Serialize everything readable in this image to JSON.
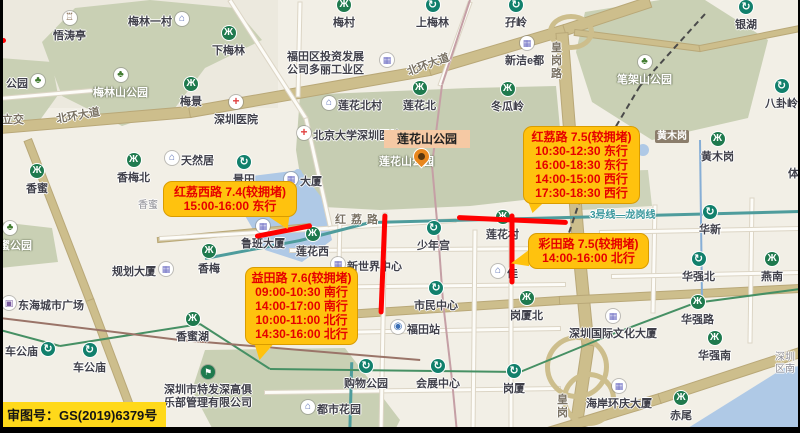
{
  "map": {
    "attribution": "审图号：GS(2019)6379号",
    "park_overlay_label": "莲花山公园",
    "labels": [
      {
        "t": "悟涛亭",
        "x": 53,
        "y": 27,
        "ic": "pavilion",
        "ip": "a"
      },
      {
        "t": "梅林一村",
        "x": 128,
        "y": 13,
        "ic": "house",
        "ip": "r"
      },
      {
        "t": "下梅林",
        "x": 212,
        "y": 42,
        "ic": "szmt",
        "ip": "a"
      },
      {
        "t": "梅村",
        "x": 333,
        "y": 14,
        "ic": "szmt",
        "ip": "a"
      },
      {
        "t": "上梅林",
        "x": 416,
        "y": 14,
        "ic": "mtr",
        "ip": "a"
      },
      {
        "t": "孖岭",
        "x": 505,
        "y": 14,
        "ic": "mtr",
        "ip": "a"
      },
      {
        "t": "银湖",
        "x": 735,
        "y": 16,
        "ic": "mtr",
        "ip": "a"
      },
      {
        "t": "福田区投资发展",
        "x": 287,
        "y": 48
      },
      {
        "t": "公司多丽工业区",
        "x": 287,
        "y": 61
      },
      {
        "t": "",
        "x": 380,
        "y": 53,
        "ic": "building"
      },
      {
        "t": "新洁e都",
        "x": 505,
        "y": 52,
        "ic": "building",
        "ip": "a"
      },
      {
        "t": "公园",
        "x": 6,
        "y": 75,
        "ic": "tree",
        "ip": "r"
      },
      {
        "t": "梅林山公园",
        "x": 93,
        "y": 84,
        "cls": "park",
        "ic": "tree",
        "ip": "a"
      },
      {
        "t": "梅景",
        "x": 180,
        "y": 93,
        "ic": "szmt",
        "ip": "a"
      },
      {
        "t": "深圳医院",
        "x": 214,
        "y": 111,
        "ic": "hosp",
        "ip": "a"
      },
      {
        "t": "北环大道",
        "x": 56,
        "y": 107,
        "cls": "road",
        "r": -10
      },
      {
        "t": "北环大道",
        "x": 406,
        "y": 56,
        "cls": "road",
        "r": -20
      },
      {
        "t": "立交",
        "x": 2,
        "y": 111,
        "cls": "road"
      },
      {
        "t": "莲花北村",
        "x": 338,
        "y": 97,
        "ic": "house",
        "ip": "l"
      },
      {
        "t": "莲花北",
        "x": 403,
        "y": 97,
        "ic": "szmt",
        "ip": "a"
      },
      {
        "t": "冬瓜岭",
        "x": 491,
        "y": 98,
        "ic": "szmt",
        "ip": "a"
      },
      {
        "t": "北京大学深圳医院",
        "x": 313,
        "y": 127,
        "ic": "hosp",
        "ip": "l"
      },
      {
        "t": "笔架山公园",
        "x": 617,
        "y": 71,
        "cls": "park",
        "ic": "tree",
        "ip": "a"
      },
      {
        "t": "八卦岭",
        "x": 765,
        "y": 95,
        "ic": "mtr",
        "ip": "a"
      },
      {
        "t": "皇岗路",
        "x": 551,
        "y": 42,
        "cls": "road vert"
      },
      {
        "t": "黄木岗",
        "x": 655,
        "y": 130,
        "cls": "roadsign"
      },
      {
        "t": "黄木岗",
        "x": 701,
        "y": 148,
        "ic": "szmt",
        "ip": "a"
      },
      {
        "t": "体",
        "x": 788,
        "y": 165
      },
      {
        "t": "天然居",
        "x": 181,
        "y": 152,
        "ic": "house",
        "ip": "l"
      },
      {
        "t": "香梅北",
        "x": 117,
        "y": 169,
        "ic": "szmt",
        "ip": "a"
      },
      {
        "t": "香蜜",
        "x": 26,
        "y": 180,
        "ic": "szmt",
        "ip": "a"
      },
      {
        "t": "景田",
        "x": 233,
        "y": 171,
        "ic": "mtr",
        "ip": "a"
      },
      {
        "t": "大厦",
        "x": 300,
        "y": 173,
        "ic": "building",
        "ip": "l"
      },
      {
        "t": "香蜜",
        "x": 138,
        "y": 196,
        "cls": "small"
      },
      {
        "t": "香蜜公园",
        "x": -12,
        "y": 237,
        "cls": "park",
        "ic": "tree",
        "ip": "a"
      },
      {
        "t": "规划大厦",
        "x": 112,
        "y": 263,
        "ic": "building",
        "ip": "r"
      },
      {
        "t": "香梅",
        "x": 198,
        "y": 260,
        "ic": "szmt",
        "ip": "a"
      },
      {
        "t": "鲁班大厦",
        "x": 241,
        "y": 235,
        "ic": "building",
        "ip": "a"
      },
      {
        "t": "莲花西",
        "x": 296,
        "y": 243,
        "ic": "szmt",
        "ip": "a"
      },
      {
        "t": "红荔路",
        "x": 335,
        "y": 211,
        "cls": "road ls"
      },
      {
        "t": "新世界中心",
        "x": 347,
        "y": 258,
        "ic": "building",
        "ip": "l"
      },
      {
        "t": "少年宫",
        "x": 417,
        "y": 237,
        "ic": "mtr",
        "ip": "a"
      },
      {
        "t": "莲花村",
        "x": 486,
        "y": 226,
        "ic": "szmt",
        "ip": "a"
      },
      {
        "t": "公园",
        "x": 596,
        "y": 186,
        "cls": "park"
      },
      {
        "t": "3号线—龙岗线",
        "x": 590,
        "y": 206,
        "cls": "teal"
      },
      {
        "t": "华新",
        "x": 699,
        "y": 221,
        "ic": "mtr",
        "ip": "a"
      },
      {
        "t": "市民中心",
        "x": 414,
        "y": 297,
        "ic": "mtr",
        "ip": "a"
      },
      {
        "t": "岗厦北",
        "x": 510,
        "y": 307,
        "ic": "szmt",
        "ip": "a"
      },
      {
        "t": "福田站",
        "x": 407,
        "y": 321,
        "ic": "rail",
        "ip": "l"
      },
      {
        "t": "佳",
        "x": 507,
        "y": 265,
        "ic": "house",
        "ip": "l"
      },
      {
        "t": "华强北",
        "x": 682,
        "y": 268,
        "ic": "mtr",
        "ip": "a"
      },
      {
        "t": "燕南",
        "x": 761,
        "y": 268,
        "ic": "szmt",
        "ip": "a"
      },
      {
        "t": "东海城市广场",
        "x": 18,
        "y": 297,
        "ic": "bag",
        "ip": "l"
      },
      {
        "t": "车公庙",
        "x": 5,
        "y": 343,
        "ic": "mtr",
        "ip": "r"
      },
      {
        "t": "车公庙",
        "x": 73,
        "y": 359,
        "ic": "mtr",
        "ip": "a"
      },
      {
        "t": "香蜜湖",
        "x": 176,
        "y": 328,
        "ic": "szmt",
        "ip": "a"
      },
      {
        "t": "深圳市特发深高俱",
        "x": 164,
        "y": 381,
        "ic": "golf",
        "ip": "a"
      },
      {
        "t": "乐部管理有限公司",
        "x": 164,
        "y": 394
      },
      {
        "t": "购物公园",
        "x": 344,
        "y": 375,
        "ic": "mtr",
        "ip": "a"
      },
      {
        "t": "会展中心",
        "x": 416,
        "y": 375,
        "ic": "mtr",
        "ip": "a"
      },
      {
        "t": "岗厦",
        "x": 503,
        "y": 380,
        "ic": "mtr",
        "ip": "a"
      },
      {
        "t": "都市花园",
        "x": 317,
        "y": 401,
        "ic": "house",
        "ip": "l"
      },
      {
        "t": "深圳国际文化大厦",
        "x": 569,
        "y": 325,
        "ic": "building",
        "ip": "a"
      },
      {
        "t": "华强路",
        "x": 681,
        "y": 311,
        "ic": "szmt",
        "ip": "a"
      },
      {
        "t": "华强南",
        "x": 698,
        "y": 347,
        "ic": "szmt",
        "ip": "a"
      },
      {
        "t": "海岸环庆大厦",
        "x": 586,
        "y": 395,
        "ic": "building",
        "ip": "a"
      },
      {
        "t": "赤尾",
        "x": 670,
        "y": 407,
        "ic": "szmt",
        "ip": "a"
      },
      {
        "t": "皇岗",
        "x": 557,
        "y": 394,
        "cls": "road vert"
      },
      {
        "t": "深圳",
        "x": 775,
        "y": 348,
        "cls": "small"
      },
      {
        "t": "区南",
        "x": 775,
        "y": 360,
        "cls": "small"
      },
      {
        "t": "莲花山公园",
        "x": 379,
        "y": 153,
        "cls": "park"
      }
    ]
  },
  "callouts": [
    {
      "title": "红荔西路 7.4(较拥堵)",
      "lines": [
        "15:00-16:00 东行"
      ],
      "x": 163,
      "y": 181,
      "w": 134,
      "tail": {
        "dir": "br",
        "x": 260,
        "y": 212,
        "w": 30,
        "h": 18
      }
    },
    {
      "title": "红荔路 7.5(较拥堵)",
      "lines": [
        "10:30-12:30 东行",
        "16:00-18:30 东行",
        "14:00-15:00 西行",
        "17:30-18:30 西行"
      ],
      "x": 523,
      "y": 126,
      "w": 117,
      "tail": {
        "dir": "bl",
        "x": 526,
        "y": 196,
        "w": 26,
        "h": 17
      }
    },
    {
      "title": "彩田路 7.5(较拥堵)",
      "lines": [
        "14:00-16:00 北行"
      ],
      "x": 528,
      "y": 233,
      "w": 121,
      "tail": {
        "dir": "l",
        "x": 511,
        "y": 249,
        "w": 18,
        "h": 18
      }
    },
    {
      "title": "益田路 7.6(较拥堵)",
      "lines": [
        "09:00-10:30 南行",
        "14:00-17:00 南行",
        "10:00-11:00 北行",
        "14:30-16:00 北行"
      ],
      "x": 245,
      "y": 267,
      "w": 113,
      "tail": {
        "dir": "bl",
        "x": 253,
        "y": 339,
        "w": 26,
        "h": 21
      }
    }
  ],
  "congestion_lines": [
    {
      "x1": 255,
      "y1": 236,
      "x2": 312,
      "y2": 225
    },
    {
      "x1": 385,
      "y1": 213,
      "x2": 381,
      "y2": 314
    },
    {
      "x1": 457,
      "y1": 217,
      "x2": 568,
      "y2": 222
    },
    {
      "x1": 512,
      "y1": 213,
      "x2": 512,
      "y2": 284
    },
    {
      "x1": 0,
      "y1": 40,
      "x2": 6,
      "y2": 40
    }
  ],
  "colors": {
    "callout_bg": "#FFC20E",
    "callout_text": "#E60000",
    "congestion_red": "#FF0000",
    "park_label_bg": "#F5C9A4",
    "attribution_bg": "#FFD91A",
    "park_green": "#C9D0B4",
    "water_blue": "#AFC9E6"
  }
}
